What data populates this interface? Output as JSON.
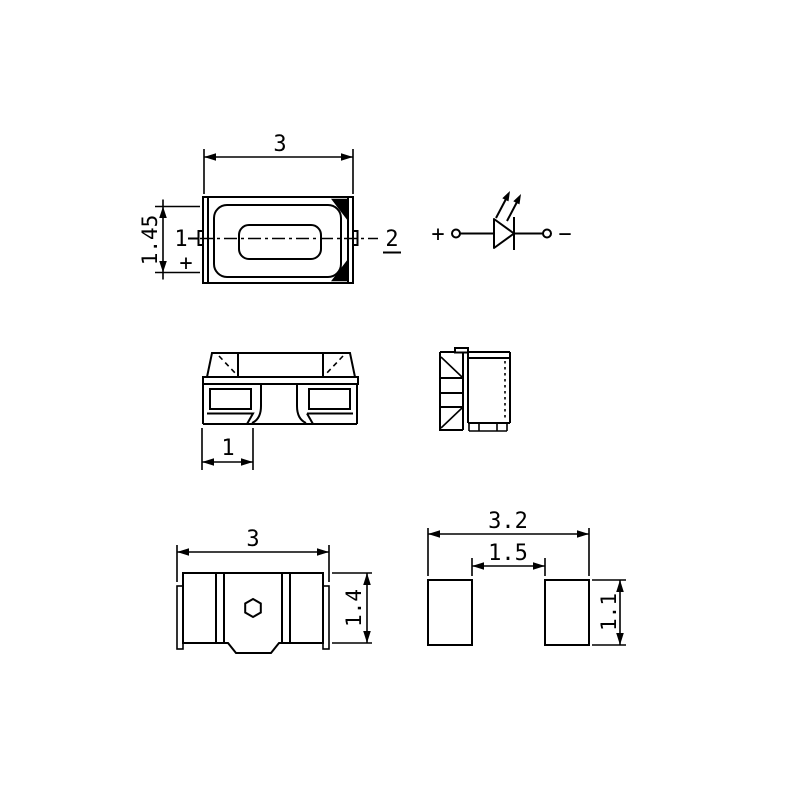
{
  "page": {
    "background": "#ffffff",
    "line_color": "#000000",
    "kind": "SMD LED package outline drawing"
  },
  "views": {
    "top_view": {
      "width_dim": "3",
      "height_dim": "1.45",
      "pin1_label": "1",
      "pin1_polarity": "+",
      "pin2_label": "2"
    },
    "schematic": {
      "anode_label": "+",
      "cathode_label": "−"
    },
    "front_view": {
      "terminal_width_dim": "1"
    },
    "bottom_view": {
      "width_dim": "3",
      "height_dim": "1.4"
    },
    "pad_layout": {
      "overall_width_dim": "3.2",
      "pad_gap_dim": "1.5",
      "pad_height_dim": "1.1"
    }
  }
}
